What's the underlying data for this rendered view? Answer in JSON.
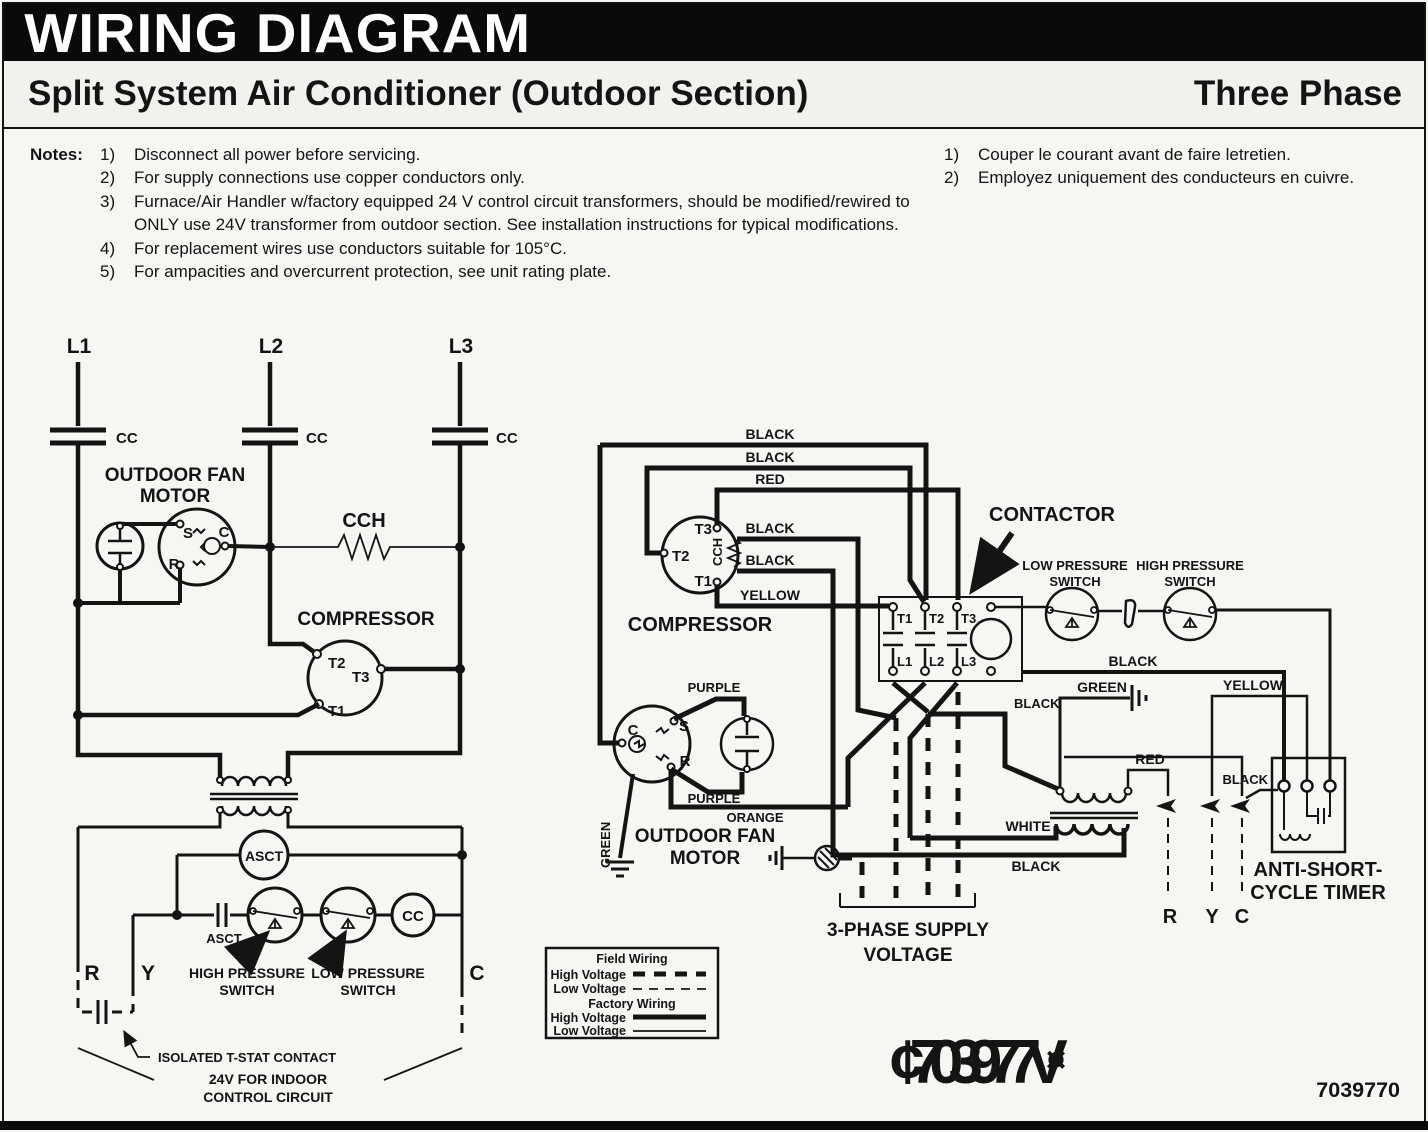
{
  "header": {
    "title": "WIRING DIAGRAM",
    "subtitle": "Split System Air Conditioner (Outdoor Section)",
    "phase": "Three Phase"
  },
  "notes": {
    "label": "Notes:",
    "en": [
      {
        "num": "1)",
        "text": "Disconnect all power before servicing."
      },
      {
        "num": "2)",
        "text": "For supply connections use copper conductors only."
      },
      {
        "num": "3)",
        "text": "Furnace/Air Handler w/factory equipped 24 V control circuit transformers, should be modified/rewired to ONLY use 24V transformer from outdoor section. See installation instructions for typical modifications."
      },
      {
        "num": "4)",
        "text": "For replacement wires use conductors suitable for 105°C."
      },
      {
        "num": "5)",
        "text": "For ampacities and overcurrent protection, see unit rating plate."
      }
    ],
    "fr": [
      {
        "num": "1)",
        "text": "Couper le courant avant de faire letretien."
      },
      {
        "num": "2)",
        "text": "Employez uniquement des conducteurs en cuivre."
      }
    ]
  },
  "diagram": {
    "labels": {
      "l1": "L1",
      "l2": "L2",
      "l3": "L3",
      "cc": "CC",
      "cch": "CCH",
      "outdoor_fan": "OUTDOOR FAN",
      "motor": "MOTOR",
      "s": "S",
      "c": "C",
      "r": "R",
      "compressor": "COMPRESSOR",
      "t1": "T1",
      "t2": "T2",
      "t3": "T3",
      "asct": "ASCT",
      "high_pressure": "HIGH PRESSURE",
      "low_pressure": "LOW PRESSURE",
      "switch": "SWITCH",
      "r_term": "R",
      "y_term": "Y",
      "c_term": "C",
      "isolated_tstat": "ISOLATED T-STAT CONTACT",
      "v24_line1": "24V FOR INDOOR",
      "v24_line2": "CONTROL CIRCUIT",
      "contactor": "CONTACTOR",
      "black": "BLACK",
      "red": "RED",
      "yellow": "YELLOW",
      "green": "GREEN",
      "purple": "PURPLE",
      "orange": "ORANGE",
      "white": "WHITE",
      "anti_short": "ANTI-SHORT-",
      "cycle_timer": "CYCLE TIMER",
      "supply_line1": "3-PHASE SUPPLY",
      "supply_line2": "VOLTAGE"
    },
    "legend": {
      "field": "Field Wiring",
      "factory": "Factory Wiring",
      "high": "High Voltage",
      "low": "Low Voltage"
    },
    "footer": {
      "watermark": "¢703977V",
      "watermark_symbol": "¤",
      "part_number": "7039770"
    }
  },
  "colors": {
    "ink": "#141414",
    "paper": "#f7f6f2"
  }
}
